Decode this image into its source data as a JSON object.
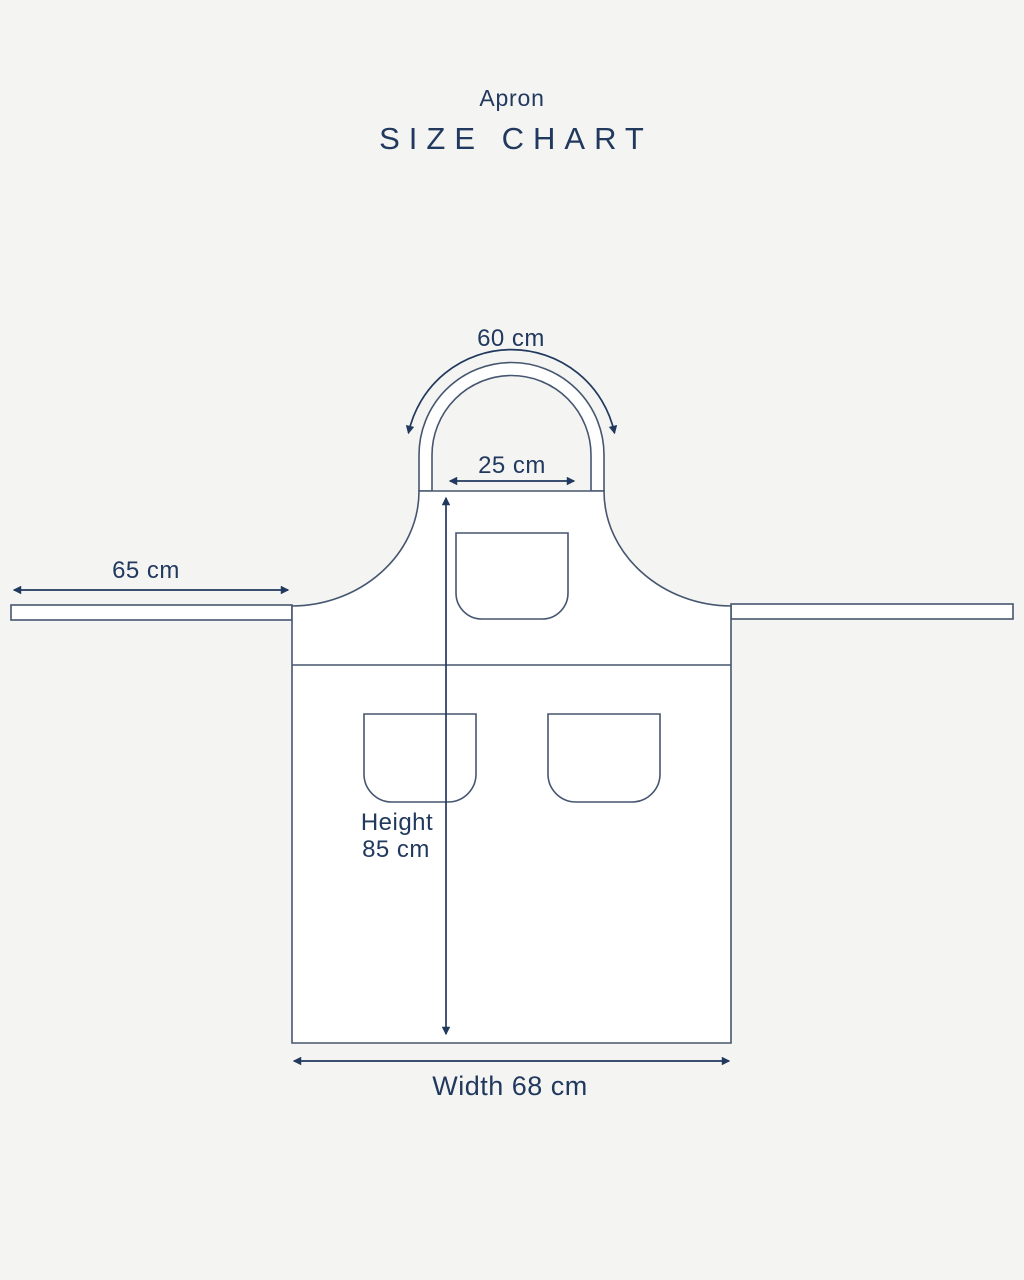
{
  "colors": {
    "background": "#f4f4f2",
    "outline": "#46566f",
    "ink": "#21395e",
    "garment_fill": "#ffffff"
  },
  "header": {
    "title": "Apron",
    "subtitle": "SIZE CHART"
  },
  "labels": {
    "neck_strap": "60 cm",
    "bib_width": "25 cm",
    "waist_tie": "65 cm",
    "height_line1": "Height",
    "height_line2": "85 cm",
    "width": "Width 68 cm"
  },
  "measurements": {
    "neck_strap_cm": 60,
    "bib_width_cm": 25,
    "waist_tie_cm": 65,
    "height_cm": 85,
    "width_cm": 68
  }
}
